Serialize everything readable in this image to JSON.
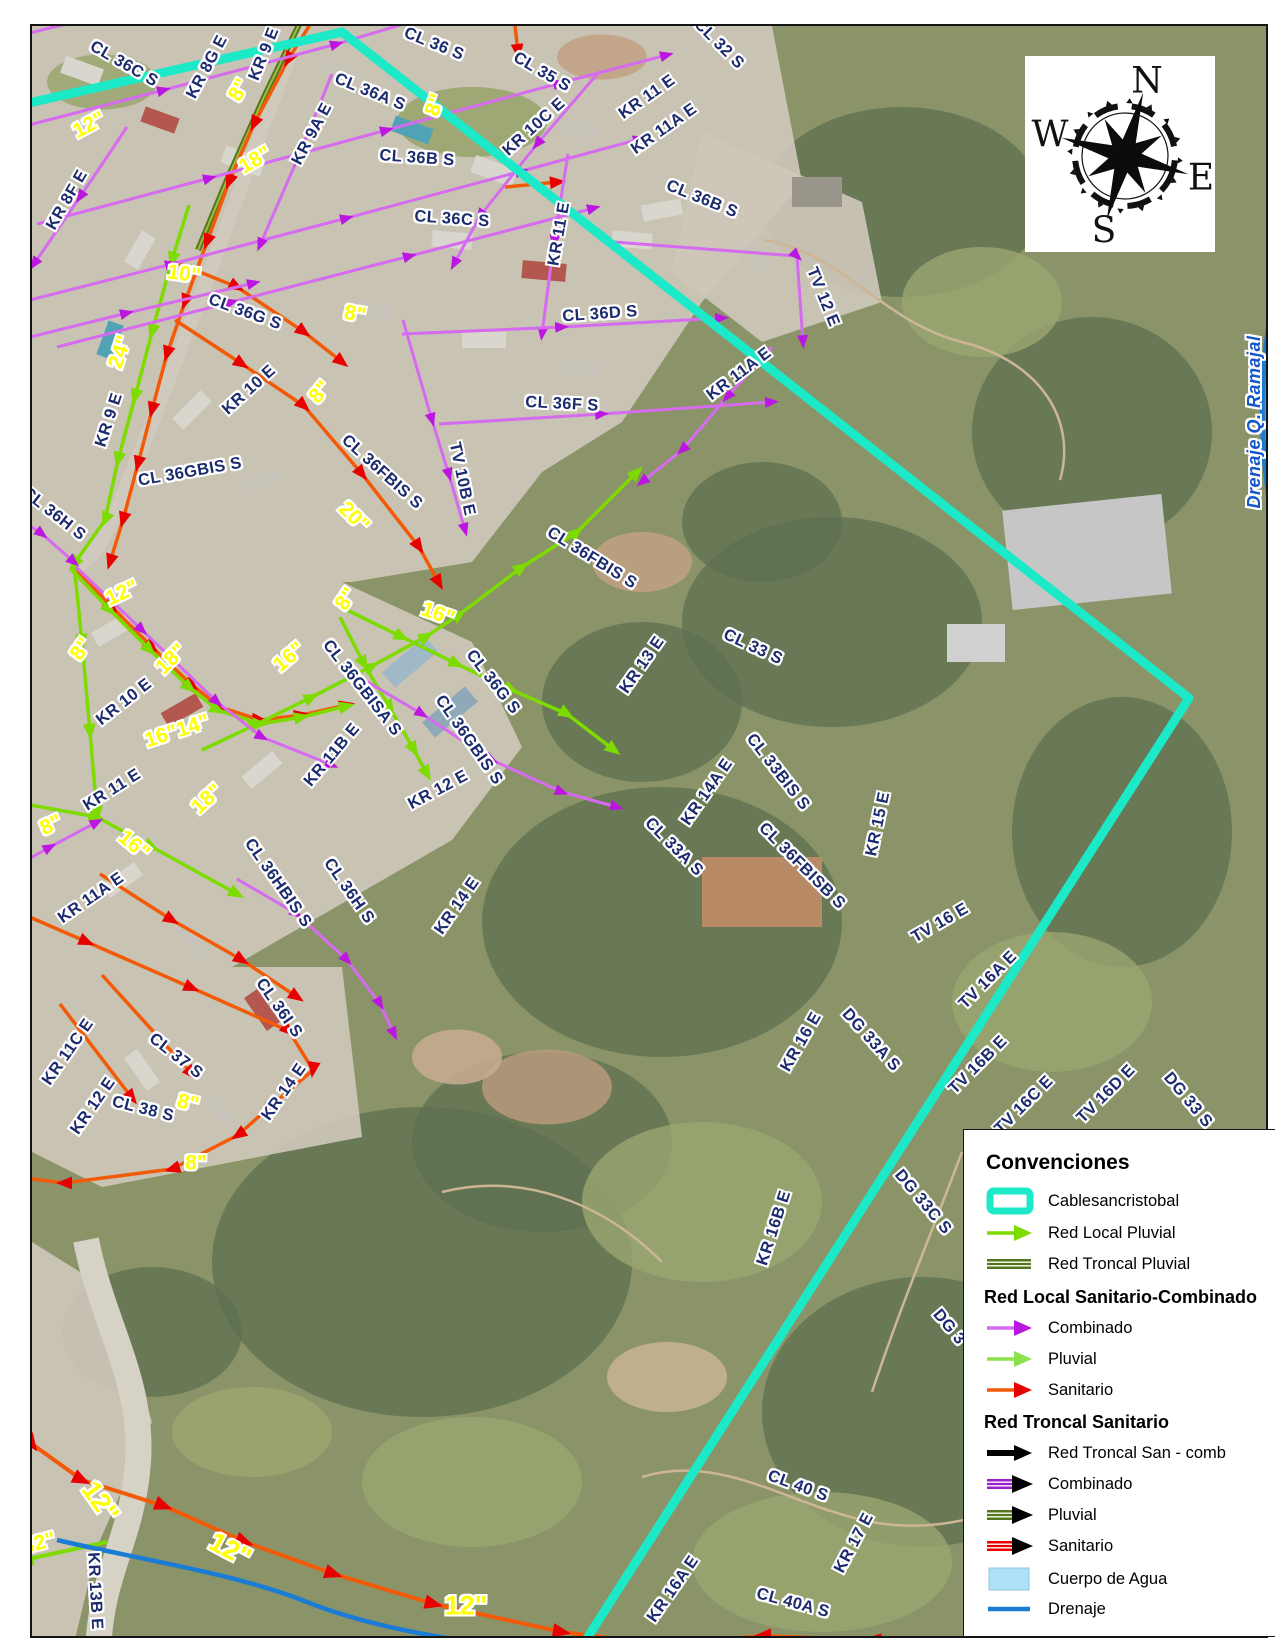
{
  "colors": {
    "cyan": "#1BE9C8",
    "magentaLine": "#D66BF0",
    "magentaHead": "#BB17E0",
    "greenLine": "#7EDB00",
    "greenSoft": "#8CE24C",
    "olive": "#55761B",
    "oliveLight": "#9DBE43",
    "orange": "#F25A08",
    "redHead": "#E80000",
    "blue": "#1B7CD6",
    "navy": "#1C2B6E",
    "pipeYellow": "#FFFF00",
    "black": "#000000",
    "purple": "#9B1FC9",
    "waterFill": "#AEE0F8",
    "drainText": "#1456C8"
  },
  "compass": {
    "n": "N",
    "e": "E",
    "s": "S",
    "w": "W"
  },
  "legend": {
    "title": "Convenciones",
    "items": [
      {
        "type": "cable",
        "label": "Cablesancristobal",
        "y": 71
      },
      {
        "type": "arrow",
        "line": "greenLine",
        "head": "greenLine",
        "label": "Red Local Pluvial",
        "y": 103
      },
      {
        "type": "stripe",
        "color": "olive",
        "label": "Red Troncal Pluvial",
        "y": 134
      },
      {
        "type": "header",
        "label": "Red Local Sanitario-Combinado",
        "y": 167
      },
      {
        "type": "arrow",
        "line": "magentaLine",
        "head": "magentaHead",
        "label": "Combinado",
        "y": 198
      },
      {
        "type": "arrow",
        "line": "greenSoft",
        "head": "greenSoft",
        "label": "Pluvial",
        "y": 229
      },
      {
        "type": "arrow",
        "line": "orange",
        "head": "redHead",
        "label": "Sanitario",
        "y": 260
      },
      {
        "type": "header",
        "label": "Red Troncal Sanitario",
        "y": 292
      },
      {
        "type": "arrowThick",
        "line": "black",
        "head": "black",
        "label": "Red Troncal San - comb",
        "y": 323
      },
      {
        "type": "stripeArrow",
        "color": "purple",
        "label": "Combinado",
        "y": 354
      },
      {
        "type": "stripeArrow",
        "color": "olive",
        "label": "Pluvial",
        "y": 385
      },
      {
        "type": "stripeArrow",
        "color": "redHead",
        "label": "Sanitario",
        "y": 416
      },
      {
        "type": "fill",
        "color": "waterFill",
        "label": "Cuerpo de Agua",
        "y": 449
      },
      {
        "type": "line",
        "color": "blue",
        "label": "Drenaje",
        "y": 479
      }
    ]
  },
  "map": {
    "labels": [
      {
        "t": "CL 36C S",
        "x": 122,
        "y": 62,
        "r": 30,
        "k": "street"
      },
      {
        "t": "KR 8G E",
        "x": 205,
        "y": 65,
        "r": -62,
        "k": "street"
      },
      {
        "t": "KR 9 E",
        "x": 262,
        "y": 52,
        "r": -68,
        "k": "street"
      },
      {
        "t": "CL 36 S",
        "x": 432,
        "y": 42,
        "r": 22,
        "k": "street"
      },
      {
        "t": "CL 35 S",
        "x": 540,
        "y": 70,
        "r": 30,
        "k": "street"
      },
      {
        "t": "CL 36A S",
        "x": 368,
        "y": 90,
        "r": 22,
        "k": "street"
      },
      {
        "t": "KR 9A E",
        "x": 310,
        "y": 132,
        "r": -62,
        "k": "street"
      },
      {
        "t": "KR 10C E",
        "x": 532,
        "y": 125,
        "r": -42,
        "k": "street"
      },
      {
        "t": "KR 11 E",
        "x": 645,
        "y": 95,
        "r": -35,
        "k": "street"
      },
      {
        "t": "KR 11A E",
        "x": 662,
        "y": 127,
        "r": -35,
        "k": "street"
      },
      {
        "t": "CL 32 S",
        "x": 717,
        "y": 42,
        "r": 45,
        "k": "street"
      },
      {
        "t": "CL 36B S",
        "x": 700,
        "y": 197,
        "r": 22,
        "k": "street"
      },
      {
        "t": "KR 8F E",
        "x": 65,
        "y": 198,
        "r": -60,
        "k": "street"
      },
      {
        "t": "CL 36B S",
        "x": 415,
        "y": 156,
        "r": 4,
        "k": "street"
      },
      {
        "t": "CL 36C S",
        "x": 450,
        "y": 217,
        "r": 4,
        "k": "street"
      },
      {
        "t": "KR 11 E",
        "x": 557,
        "y": 232,
        "r": -80,
        "k": "street"
      },
      {
        "t": "CL 36D S",
        "x": 598,
        "y": 312,
        "r": -4,
        "k": "street"
      },
      {
        "t": "TV 12 E",
        "x": 821,
        "y": 295,
        "r": 68,
        "k": "street"
      },
      {
        "t": "CL 36G S",
        "x": 243,
        "y": 310,
        "r": 20,
        "k": "street"
      },
      {
        "t": "KR 9 E",
        "x": 107,
        "y": 418,
        "r": -72,
        "k": "street"
      },
      {
        "t": "KR 10 E",
        "x": 247,
        "y": 388,
        "r": -42,
        "k": "street"
      },
      {
        "t": "CL 36GBIS S",
        "x": 188,
        "y": 470,
        "r": -10,
        "k": "street"
      },
      {
        "t": "CL 36H S",
        "x": 52,
        "y": 512,
        "r": 38,
        "k": "street"
      },
      {
        "t": "CL 36FBIS S",
        "x": 380,
        "y": 470,
        "r": 42,
        "k": "street"
      },
      {
        "t": "TV 10B E",
        "x": 460,
        "y": 477,
        "r": 78,
        "k": "street"
      },
      {
        "t": "CL 36F S",
        "x": 560,
        "y": 402,
        "r": 3,
        "k": "street"
      },
      {
        "t": "KR 11A E",
        "x": 737,
        "y": 372,
        "r": -37,
        "k": "street"
      },
      {
        "t": "CL 36FBIS S",
        "x": 590,
        "y": 556,
        "r": 32,
        "k": "street"
      },
      {
        "t": "KR 13 E",
        "x": 640,
        "y": 663,
        "r": -55,
        "k": "street"
      },
      {
        "t": "CL 33 S",
        "x": 751,
        "y": 645,
        "r": 25,
        "k": "street"
      },
      {
        "t": "CL 33BIS S",
        "x": 776,
        "y": 770,
        "r": 52,
        "k": "street"
      },
      {
        "t": "KR 14A E",
        "x": 705,
        "y": 790,
        "r": -55,
        "k": "street"
      },
      {
        "t": "CL 33A S",
        "x": 672,
        "y": 845,
        "r": 45,
        "k": "street"
      },
      {
        "t": "CL 36FBISB S",
        "x": 800,
        "y": 864,
        "r": 45,
        "k": "street"
      },
      {
        "t": "KR 15 E",
        "x": 876,
        "y": 822,
        "r": -78,
        "k": "street"
      },
      {
        "t": "KR 10 E",
        "x": 122,
        "y": 700,
        "r": -38,
        "k": "street"
      },
      {
        "t": "KR 11 E",
        "x": 110,
        "y": 788,
        "r": -32,
        "k": "street"
      },
      {
        "t": "KR 11B E",
        "x": 330,
        "y": 753,
        "r": -50,
        "k": "street"
      },
      {
        "t": "CL 36GBISA S",
        "x": 360,
        "y": 686,
        "r": 52,
        "k": "street"
      },
      {
        "t": "CL 36G S",
        "x": 491,
        "y": 680,
        "r": 52,
        "k": "street"
      },
      {
        "t": "CL 36GBIS S",
        "x": 467,
        "y": 738,
        "r": 55,
        "k": "street"
      },
      {
        "t": "KR 12 E",
        "x": 436,
        "y": 788,
        "r": -28,
        "k": "street"
      },
      {
        "t": "KR 11A E",
        "x": 89,
        "y": 896,
        "r": -35,
        "k": "street"
      },
      {
        "t": "CL 36HBIS S",
        "x": 276,
        "y": 881,
        "r": 55,
        "k": "street"
      },
      {
        "t": "CL 36H S",
        "x": 347,
        "y": 889,
        "r": 55,
        "k": "street"
      },
      {
        "t": "KR 14 E",
        "x": 455,
        "y": 904,
        "r": -55,
        "k": "street"
      },
      {
        "t": "CL 36I S",
        "x": 277,
        "y": 1006,
        "r": 55,
        "k": "street"
      },
      {
        "t": "CL 37 S",
        "x": 174,
        "y": 1054,
        "r": 38,
        "k": "street"
      },
      {
        "t": "KR 11C E",
        "x": 66,
        "y": 1050,
        "r": -55,
        "k": "street"
      },
      {
        "t": "KR 12 E",
        "x": 91,
        "y": 1104,
        "r": -55,
        "k": "street"
      },
      {
        "t": "KR 14 E",
        "x": 282,
        "y": 1090,
        "r": -55,
        "k": "street"
      },
      {
        "t": "CL 38 S",
        "x": 141,
        "y": 1107,
        "r": 14,
        "k": "street"
      },
      {
        "t": "TV 16 E",
        "x": 938,
        "y": 921,
        "r": -30,
        "k": "street"
      },
      {
        "t": "TV 16A E",
        "x": 986,
        "y": 978,
        "r": -45,
        "k": "street"
      },
      {
        "t": "KR 16 E",
        "x": 799,
        "y": 1040,
        "r": -60,
        "k": "street"
      },
      {
        "t": "DG 33A S",
        "x": 869,
        "y": 1038,
        "r": 48,
        "k": "street"
      },
      {
        "t": "TV 16B E",
        "x": 976,
        "y": 1063,
        "r": -45,
        "k": "street"
      },
      {
        "t": "TV 16C E",
        "x": 1022,
        "y": 1103,
        "r": -45,
        "k": "street"
      },
      {
        "t": "TV 16D E",
        "x": 1104,
        "y": 1092,
        "r": -45,
        "k": "street"
      },
      {
        "t": "DG 33 S",
        "x": 1186,
        "y": 1098,
        "r": 50,
        "k": "street"
      },
      {
        "t": "DG 33C S",
        "x": 921,
        "y": 1200,
        "r": 50,
        "k": "street"
      },
      {
        "t": "DG 3",
        "x": 947,
        "y": 1325,
        "r": 50,
        "k": "street"
      },
      {
        "t": "KR 16B E",
        "x": 772,
        "y": 1226,
        "r": -72,
        "k": "street"
      },
      {
        "t": "CL 40 S",
        "x": 796,
        "y": 1484,
        "r": 20,
        "k": "street"
      },
      {
        "t": "KR 17 E",
        "x": 852,
        "y": 1541,
        "r": -62,
        "k": "street"
      },
      {
        "t": "KR 16A E",
        "x": 671,
        "y": 1587,
        "r": -55,
        "k": "street"
      },
      {
        "t": "CL 40A S",
        "x": 791,
        "y": 1601,
        "r": 15,
        "k": "street"
      },
      {
        "t": "KR 13B E",
        "x": 93,
        "y": 1589,
        "r": 87,
        "k": "street"
      },
      {
        "t": "8\"",
        "x": 237,
        "y": 88,
        "r": -60,
        "k": "pipe"
      },
      {
        "t": "12\"",
        "x": 87,
        "y": 123,
        "r": -28,
        "k": "pipe"
      },
      {
        "t": "18\"",
        "x": 253,
        "y": 158,
        "r": -30,
        "k": "pipe"
      },
      {
        "t": "8\"",
        "x": 433,
        "y": 103,
        "r": -70,
        "k": "pipe"
      },
      {
        "t": "10\"",
        "x": 182,
        "y": 272,
        "r": 8,
        "k": "pipe"
      },
      {
        "t": "24\"",
        "x": 118,
        "y": 350,
        "r": -72,
        "k": "pipe"
      },
      {
        "t": "8\"",
        "x": 318,
        "y": 390,
        "r": -50,
        "k": "pipe"
      },
      {
        "t": "8\"",
        "x": 353,
        "y": 312,
        "r": 10,
        "k": "pipe"
      },
      {
        "t": "20\"",
        "x": 352,
        "y": 515,
        "r": 45,
        "k": "pipe"
      },
      {
        "t": "12\"",
        "x": 120,
        "y": 591,
        "r": -25,
        "k": "pipe"
      },
      {
        "t": "8\"",
        "x": 79,
        "y": 647,
        "r": -55,
        "k": "pipe"
      },
      {
        "t": "18\"",
        "x": 169,
        "y": 657,
        "r": -45,
        "k": "pipe"
      },
      {
        "t": "16\"14\"",
        "x": 175,
        "y": 729,
        "r": -18,
        "k": "pipe"
      },
      {
        "t": "18\"",
        "x": 205,
        "y": 797,
        "r": -42,
        "k": "pipe"
      },
      {
        "t": "16\"",
        "x": 287,
        "y": 655,
        "r": -40,
        "k": "pipe"
      },
      {
        "t": "8\"",
        "x": 344,
        "y": 597,
        "r": -55,
        "k": "pipe"
      },
      {
        "t": "16\"",
        "x": 436,
        "y": 612,
        "r": 20,
        "k": "pipe"
      },
      {
        "t": "8\"",
        "x": 49,
        "y": 823,
        "r": -25,
        "k": "pipe"
      },
      {
        "t": "16\"",
        "x": 132,
        "y": 843,
        "r": 40,
        "k": "pipe"
      },
      {
        "t": "8\"",
        "x": 186,
        "y": 1101,
        "r": 14,
        "k": "pipe"
      },
      {
        "t": "8\"",
        "x": 194,
        "y": 1161,
        "r": 0,
        "k": "pipe"
      },
      {
        "t": "12\"",
        "x": 98,
        "y": 1500,
        "r": 55,
        "k": "pipelg"
      },
      {
        "t": "12\"",
        "x": 228,
        "y": 1548,
        "r": 28,
        "k": "pipelg"
      },
      {
        "t": "32\"",
        "x": 37,
        "y": 1541,
        "r": -15,
        "k": "pipe"
      },
      {
        "t": "12\"",
        "x": 464,
        "y": 1604,
        "r": 0,
        "k": "pipelg"
      },
      {
        "t": "Drenaje Q. Ramajal",
        "x": 1252,
        "y": 420,
        "r": -90,
        "k": "drain"
      }
    ],
    "lines": [
      {
        "c": "olive",
        "w": 6,
        "p": "308,0 262,95 225,178 196,248"
      },
      {
        "c": "oliveLight",
        "w": 2,
        "p": "308,0 262,95 225,178 196,248"
      },
      {
        "c": "orange",
        "w": 3.5,
        "a": "red",
        "p": "322,0 286,58 252,122 227,180 205,240 183,300 165,352 150,408 136,462 121,518 108,560"
      },
      {
        "c": "orange",
        "w": 3.5,
        "a": "red",
        "p": "173,318 240,362 302,404 360,472 417,545 437,581"
      },
      {
        "c": "orange",
        "w": 3.5,
        "a": "red",
        "p": "168,258 235,285 302,330 340,360"
      },
      {
        "c": "orange",
        "w": 3.5,
        "a": "red",
        "p": "468,12 512,15 516,50"
      },
      {
        "c": "orange",
        "w": 3.5,
        "a": "red",
        "p": "503,185 556,180"
      },
      {
        "c": "orange",
        "w": 3.5,
        "a": "red",
        "p": "737,13 772,3"
      },
      {
        "c": "orange",
        "w": 3.5,
        "a": "red",
        "p": "70,563 110,605 150,645 190,683 218,705 258,718 300,713 345,703"
      },
      {
        "c": "orange",
        "w": 3.5,
        "a": "red",
        "p": "0,903 85,940 190,986 287,1029 311,1068 262,1110 236,1133 170,1167 62,1181 0,1173"
      },
      {
        "c": "orange",
        "w": 3.5,
        "a": "red",
        "p": "58,1002 130,1096"
      },
      {
        "c": "orange",
        "w": 3.5,
        "a": "red",
        "p": "100,973 190,1072"
      },
      {
        "c": "orange",
        "w": 3.5,
        "a": "red",
        "p": "98,872 170,918 240,958 295,995"
      },
      {
        "c": "orange",
        "w": 4,
        "a": "red",
        "p": "8,1302 22,1345 12,1378 30,1442 80,1478 162,1504 243,1540 332,1572 432,1602 560,1630 700,1648"
      },
      {
        "c": "orange",
        "w": 4,
        "a": "red",
        "p": "985,1650 870,1638 760,1634 648,1644"
      },
      {
        "c": "greenLine",
        "w": 3.5,
        "a": "green",
        "p": "187,203 170,258 150,330 133,395 116,458 103,518 72,562"
      },
      {
        "c": "greenLine",
        "w": 3.5,
        "a": "green",
        "p": "68,566 108,608 148,648 188,686 216,708 258,722 300,715 345,704"
      },
      {
        "c": "greenLine",
        "w": 3.5,
        "a": "green",
        "p": "200,748 255,722 310,695 370,664 425,634 458,612 520,565 575,530 635,470"
      },
      {
        "c": "greenLine",
        "w": 3.5,
        "a": "green",
        "p": "345,608 400,635 455,662 510,688 565,712 612,748"
      },
      {
        "c": "greenLine",
        "w": 3.5,
        "a": "green",
        "p": "338,615 362,662 388,706 412,748 425,772"
      },
      {
        "c": "greenLine",
        "w": 3.5,
        "a": "green",
        "p": "72,562 80,640 88,730 95,812"
      },
      {
        "c": "greenLine",
        "w": 3.5,
        "a": "green",
        "p": "0,798 95,815 150,845 235,892"
      },
      {
        "c": "greenLine",
        "w": 4,
        "a": "green",
        "p": "105,1540 22,1558"
      },
      {
        "c": "magentaLine",
        "w": 3,
        "a": "magenta",
        "p": "8,36 120,8"
      },
      {
        "c": "magentaLine",
        "w": 3,
        "a": "magenta",
        "p": "0,130 162,88 335,42 428,14"
      },
      {
        "c": "magentaLine",
        "w": 3,
        "a": "magenta",
        "p": "35,222 208,176 385,128 558,81 665,53"
      },
      {
        "c": "magentaLine",
        "w": 3,
        "a": "magenta",
        "p": "0,305 170,262 345,216 520,169 638,137"
      },
      {
        "c": "magentaLine",
        "w": 3,
        "a": "magenta",
        "p": "55,345 230,300 408,254 592,206"
      },
      {
        "c": "magentaLine",
        "w": 3,
        "a": "magenta",
        "p": "0,342 125,311 252,281"
      },
      {
        "c": "magentaLine",
        "w": 3,
        "a": "magenta",
        "p": "125,125 78,195 32,262"
      },
      {
        "c": "magentaLine",
        "w": 3,
        "a": "magenta",
        "p": "330,72 295,158 258,243"
      },
      {
        "c": "magentaLine",
        "w": 3,
        "a": "magenta",
        "p": "597,70 535,142 478,214 452,262"
      },
      {
        "c": "magentaLine",
        "w": 3,
        "a": "magenta",
        "p": "566,152 552,240 540,332"
      },
      {
        "c": "magentaLine",
        "w": 3,
        "a": "magenta",
        "p": "400,332 560,325 720,316"
      },
      {
        "c": "magentaLine",
        "w": 3,
        "a": "magenta",
        "p": "437,422 600,412 770,400"
      },
      {
        "c": "magentaLine",
        "w": 3,
        "a": "magenta",
        "p": "401,318 430,418 447,473 463,528"
      },
      {
        "c": "magentaLine",
        "w": 3,
        "a": "magenta",
        "p": "770,345 725,395 680,448 640,480"
      },
      {
        "c": "magentaLine",
        "w": 3,
        "a": "magenta",
        "p": "612,240 795,254 801,340"
      },
      {
        "c": "magentaLine",
        "w": 3,
        "a": "magenta",
        "p": "0,505 40,532 72,560"
      },
      {
        "c": "magentaLine",
        "w": 3,
        "a": "magenta",
        "p": "74,565 140,628 215,700 260,735 330,763"
      },
      {
        "c": "magentaLine",
        "w": 3,
        "a": "magenta",
        "p": "352,672 420,712 490,758 560,790 615,805"
      },
      {
        "c": "magentaLine",
        "w": 3,
        "a": "magenta",
        "p": "0,872 48,845 95,820"
      },
      {
        "c": "magentaLine",
        "w": 3,
        "a": "magenta",
        "p": "235,877 295,912 345,958 378,1002 392,1032"
      },
      {
        "c": "cyan",
        "w": 9,
        "p": "0,107 340,30 1187,696 575,1652"
      }
    ],
    "paths": [
      {
        "c": "blue",
        "w": 4.5,
        "d": "M55,1538 C150,1560 235,1572 305,1600 C375,1628 480,1645 575,1650"
      },
      {
        "c": "blue",
        "w": 5,
        "d": "M1272,295 C1260,350 1256,420 1266,490"
      }
    ]
  }
}
